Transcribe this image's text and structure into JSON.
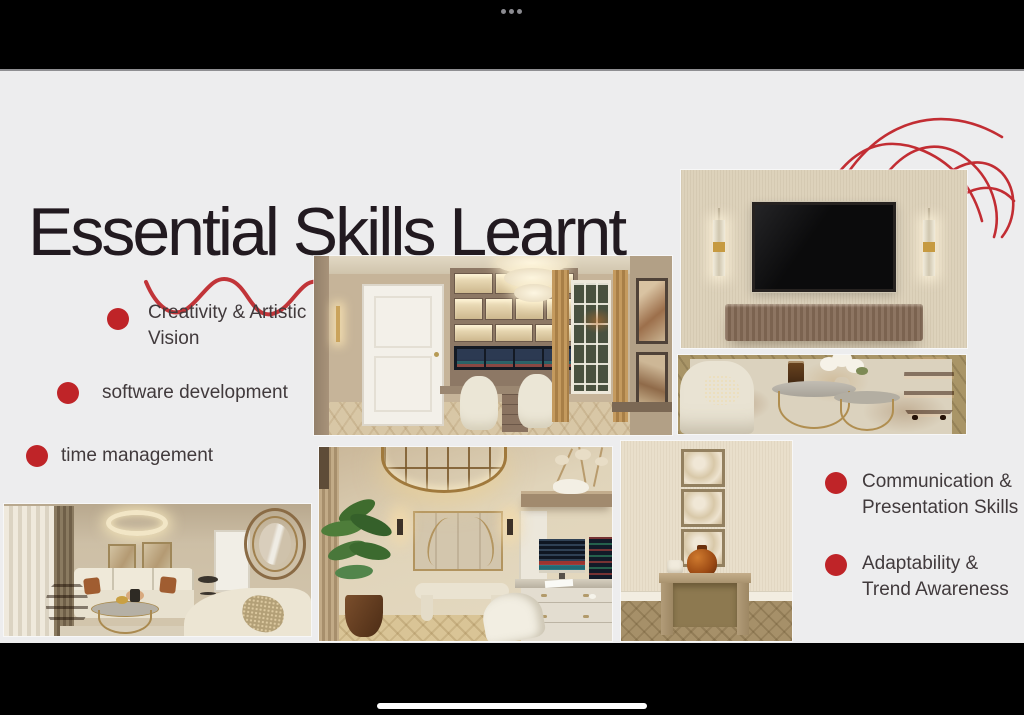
{
  "app": {
    "menu_dots_label": "•••",
    "home_indicator_name": "home-indicator"
  },
  "slide": {
    "title": "Essential Skills Learnt",
    "bullets_left": [
      "Creativity & Artistic Vision",
      "software development",
      "time management"
    ],
    "bullets_right": [
      "Communication & Presentation Skills",
      "Adaptability & Trend Awareness"
    ],
    "decorations": [
      "red-wavy-underline",
      "red-scribble-swirl"
    ],
    "images": [
      "home-office-trading-desk-render",
      "tv-accent-wall-render",
      "coffee-table-vignette-render",
      "living-room-sofa-render",
      "entry-office-pendant-render",
      "console-table-render"
    ],
    "colors": {
      "accent_red": "#bf2428",
      "slide_background": "#ededee",
      "title_text": "#221a20",
      "body_text": "#413a3c"
    }
  }
}
